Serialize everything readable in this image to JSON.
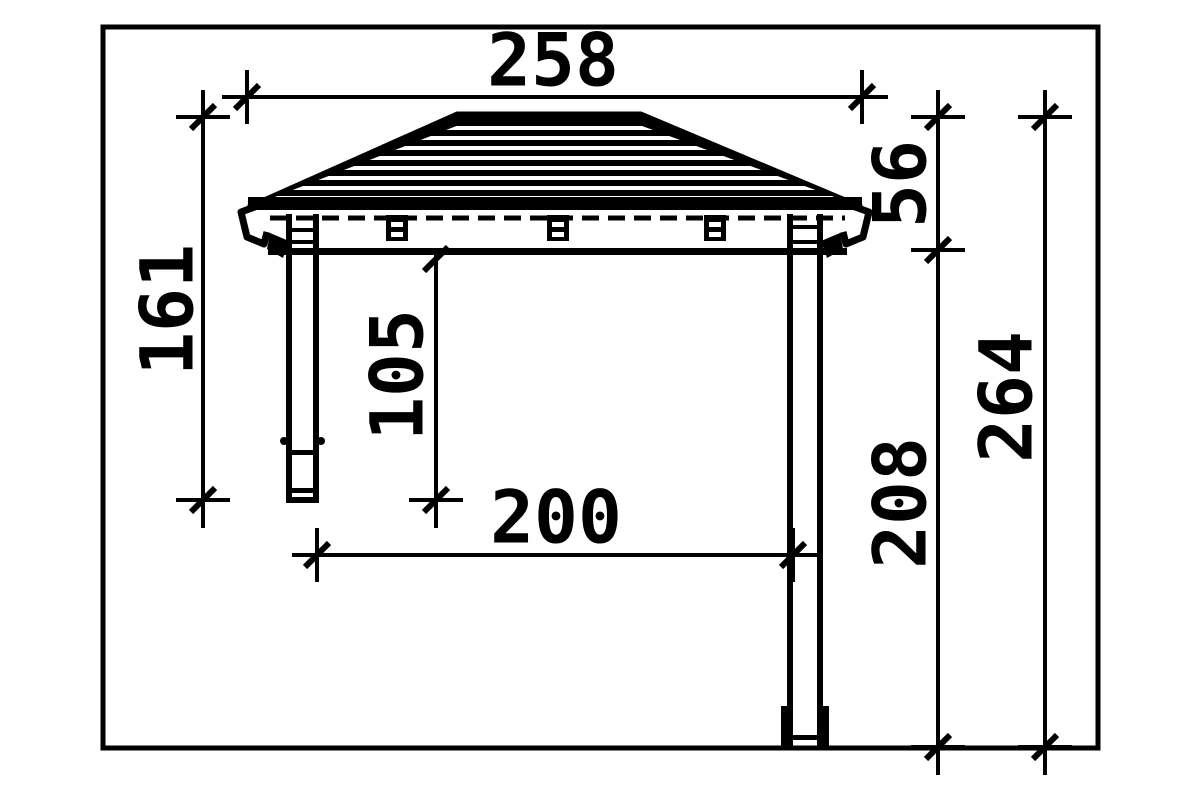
{
  "dimensions": {
    "roof_width": "258",
    "roof_height": "56",
    "left_total_height": "161",
    "clearance_height": "105",
    "post_span": "200",
    "right_wall_height": "208",
    "right_total_height": "264"
  },
  "colors": {
    "line": "#000000",
    "background": "#ffffff"
  }
}
